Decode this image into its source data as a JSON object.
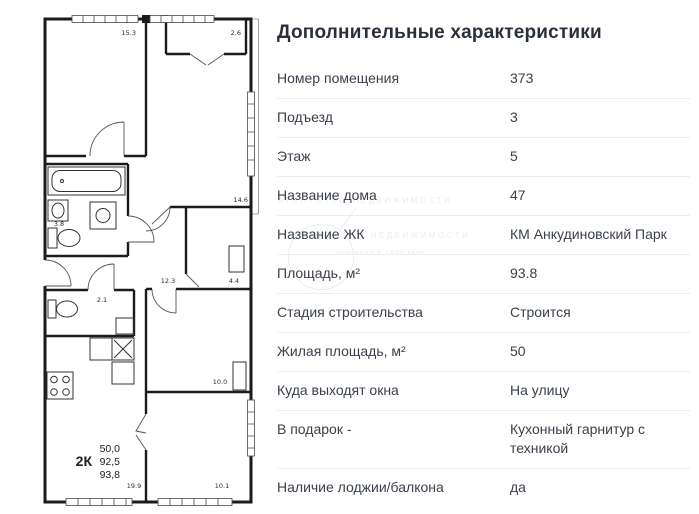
{
  "details": {
    "title": "Дополнительные характеристики",
    "rows": [
      {
        "label": "Номер помещения",
        "value": "373"
      },
      {
        "label": "Подъезд",
        "value": "3"
      },
      {
        "label": "Этаж",
        "value": "5"
      },
      {
        "label": "Название дома",
        "value": "47"
      },
      {
        "label": "Название ЖК",
        "value": "КМ Анкудиновский Парк"
      },
      {
        "label": "Площадь, м²",
        "value": "93.8"
      },
      {
        "label": "Стадия строительства",
        "value": "Строится"
      },
      {
        "label": "Жилая площадь, м²",
        "value": "50"
      },
      {
        "label": "Куда выходят окна",
        "value": "На улицу"
      },
      {
        "label": "В подарок -",
        "value": "Кухонный гарнитур с техникой"
      },
      {
        "label": "Наличие лоджии/балкона",
        "value": "да"
      }
    ]
  },
  "plan": {
    "room_labels": {
      "room_top_left": "15.3",
      "loggia": "2.6",
      "room_right": "14.6",
      "bathroom": "3.8",
      "hallway": "12.3",
      "storage": "4.4",
      "wc": "2.1",
      "room_mid_right": "10.0",
      "kitchen_living": "19.9",
      "room_bottom_right": "10.1"
    },
    "summary": {
      "type_label": "2К",
      "living_area": "50,0",
      "area_main": "92,5",
      "area_total": "93,8"
    }
  },
  "watermark": {
    "line1": "АГЕНТСТВО НЕДВИЖИМОСТИ",
    "line2": "основано в 1999 году"
  },
  "colors": {
    "title_text": "#2a303a",
    "row_text": "#3a414b",
    "divider": "#ededee",
    "wall": "#1b1b1b"
  }
}
